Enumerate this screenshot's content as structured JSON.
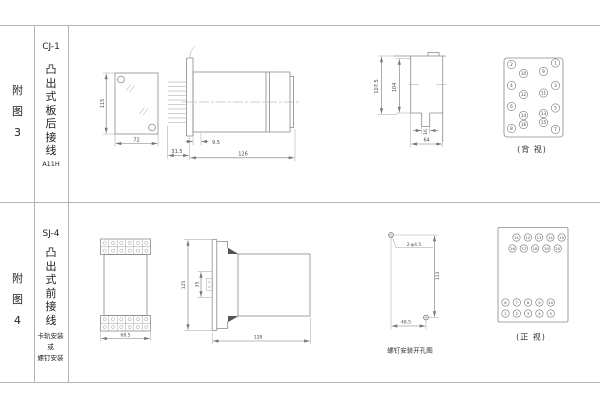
{
  "figure3": {
    "row_label": "附图3",
    "model": "CJ-1",
    "mount_type": "凸出式板后接线",
    "code": "A11H",
    "front": {
      "height": "115",
      "width": "72"
    },
    "side": {
      "d1": "31.5",
      "d2": "9.5",
      "length": "126"
    },
    "cutout": {
      "outer": "107.5",
      "inner": "104",
      "tab": "16",
      "width": "64"
    },
    "back_view": {
      "caption": "(背 视)",
      "left_outer": [
        "2",
        "4",
        "6",
        "8"
      ],
      "left_inner": [
        "10",
        "12",
        "14",
        "16"
      ],
      "right_outer": [
        "1",
        "3",
        "5",
        "7"
      ],
      "right_inner": [
        "9",
        "11",
        "13",
        "15"
      ]
    }
  },
  "figure4": {
    "row_label": "附图4",
    "model": "SJ-4",
    "mount_type": "凸出式前接线",
    "note": "卡轨安装\n或\n螺钉安装",
    "front": {
      "width": "68.5"
    },
    "side": {
      "height": "125",
      "rail": "35",
      "depth": "128"
    },
    "drill": {
      "holes": "2-φ4.5",
      "v": "113",
      "h": "48.5",
      "caption": "螺钉安装开孔图"
    },
    "front_view": {
      "caption": "(正 视)",
      "rows": [
        [
          "11",
          "12",
          "13",
          "14",
          "15"
        ],
        [
          "16",
          "17",
          "18",
          "19",
          "20"
        ],
        [
          "6",
          "7",
          "8",
          "9",
          "10"
        ],
        [
          "1",
          "2",
          "3",
          "4",
          "5"
        ]
      ]
    }
  }
}
